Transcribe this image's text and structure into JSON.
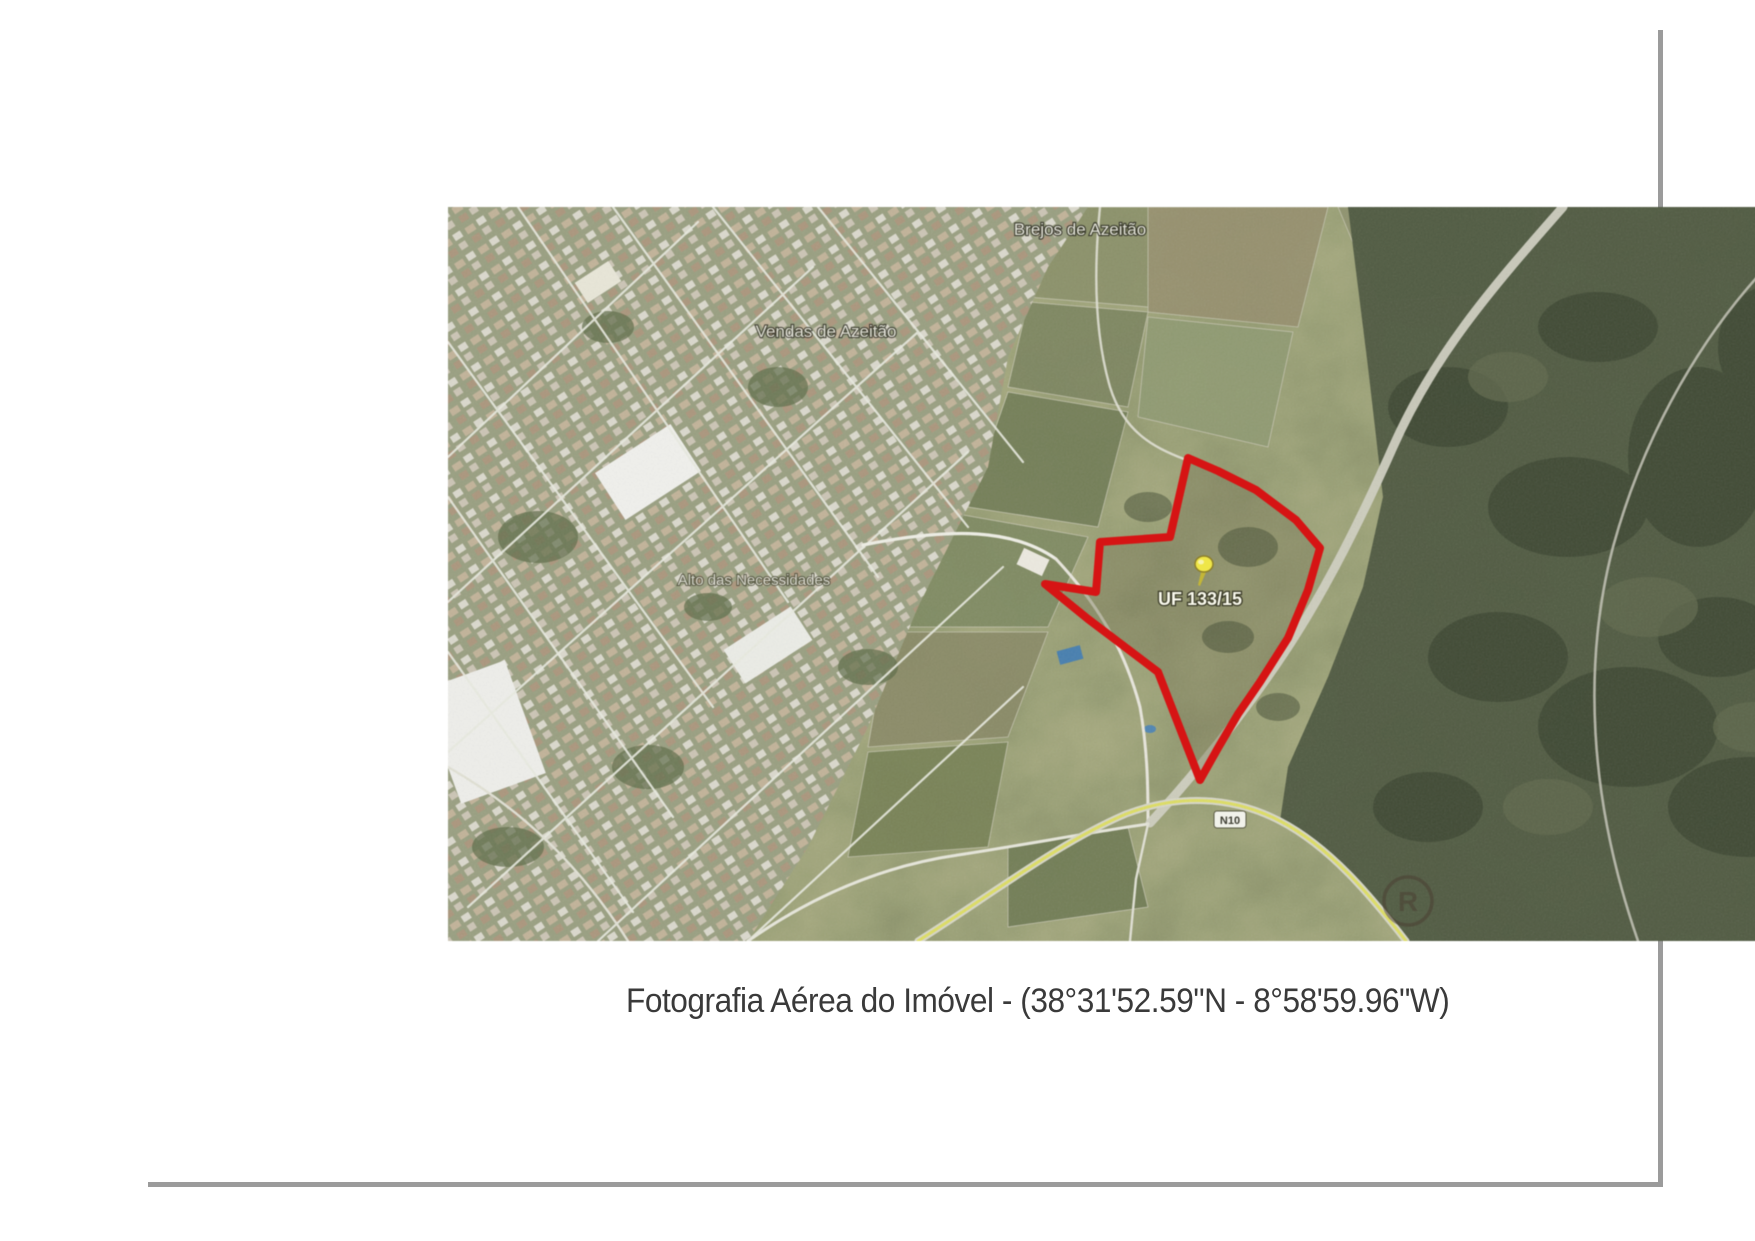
{
  "document": {
    "caption": "Fotografia Aérea do Imóvel - (38°31'52.59\"N - 8°58'59.96\"W)"
  },
  "map": {
    "place_labels": {
      "top": "Brejos de Azeitão",
      "west": "Vendas de Azeitão",
      "center": "Alto das Necessidades"
    },
    "parcel_label": "UF 133/15",
    "road_badge": "N10",
    "watermark": "R",
    "colors": {
      "boundary_red": "#e60d0d",
      "pin_yellow": "#f4ea39",
      "road_yellow": "#e2e258"
    }
  }
}
